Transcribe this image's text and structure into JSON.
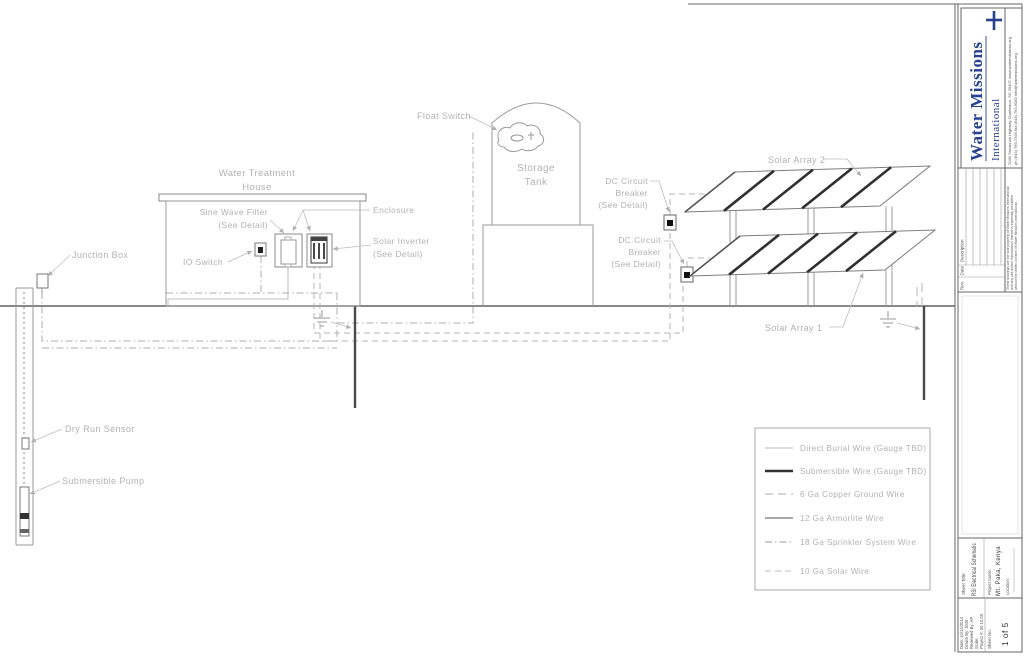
{
  "drawing": {
    "labels": {
      "junction_box": "Junction Box",
      "dry_run_sensor": "Dry Run Sensor",
      "submersible_pump": "Submersible Pump",
      "water_treatment_house_line1": "Water Treatment",
      "water_treatment_house_line2": "House",
      "sine_wave_filter_line1": "Sine Wave Filter",
      "sine_wave_filter_line2": "(See Detail)",
      "io_switch": "IO Switch",
      "enclosure": "Enclosure",
      "solar_inverter_line1": "Solar Inverter",
      "solar_inverter_line2": "(See Detail)",
      "float_switch": "Float Switch",
      "storage_tank_line1": "Storage",
      "storage_tank_line2": "Tank",
      "dc_breaker1_line1": "DC Circuit",
      "dc_breaker1_line2": "Breaker",
      "dc_breaker1_line3": "(See Detail)",
      "dc_breaker2_line1": "DC Circuit",
      "dc_breaker2_line2": "Breaker",
      "dc_breaker2_line3": "(See Detail)",
      "solar_array_2": "Solar Array 2",
      "solar_array_1": "Solar Array 1"
    }
  },
  "legend": {
    "items": [
      {
        "label": "Direct Burial Wire (Gauge TBD)",
        "style": "solid-thin"
      },
      {
        "label": "Submersible Wire (Gauge TBD)",
        "style": "solid-thick"
      },
      {
        "label": "6 Ga Copper Ground Wire",
        "style": "long-dash"
      },
      {
        "label": "12 Ga Armorlite Wire",
        "style": "solid-medium"
      },
      {
        "label": "18 Ga Sprinkler System Wire",
        "style": "dash-dot"
      },
      {
        "label": "10 Ga Solar Wire",
        "style": "dashed"
      }
    ]
  },
  "title_block": {
    "org_name_line1": "Water Missions",
    "org_name_line2": "International",
    "address_line1": "2049 Savannah Highway    Charleston, SC 29407    www.watermissions.org",
    "address_line2": "ph (843) 769-7395    fax (843) 763-6082    info@watermissions.org",
    "revision_headers": {
      "rev": "Rev.",
      "date": "Date",
      "description": "Description"
    },
    "disclaimer_line1": "These drawings are the sole property of Water Missions International",
    "disclaimer_line2": "and any use and/or reproduction thereof is expressly prohibited",
    "disclaimer_line3": "without the written consent of Water Missions International",
    "sheet_title_label": "Sheet Title:",
    "sheet_title": "RSI Electrical Schematic",
    "project_name_label": "Project name:",
    "project_name": "Mt. Paka, Kenya",
    "location_label": "Location:",
    "fields": {
      "date": "Date: 10/14/2014",
      "drawn_by": "Drawn By: SMS",
      "reviewed_by": "Reviewed By: AP",
      "scale": "Scale:",
      "project_no": "Project #: 00.10.05"
    },
    "sheet_no_label": "Sheet No.",
    "sheet_no": "1 of 5"
  },
  "colors": {
    "logo_blue": "#26418f",
    "line_gray": "#9a9a9a",
    "label_gray": "#b2b2b2",
    "panel_dark": "#303030"
  }
}
